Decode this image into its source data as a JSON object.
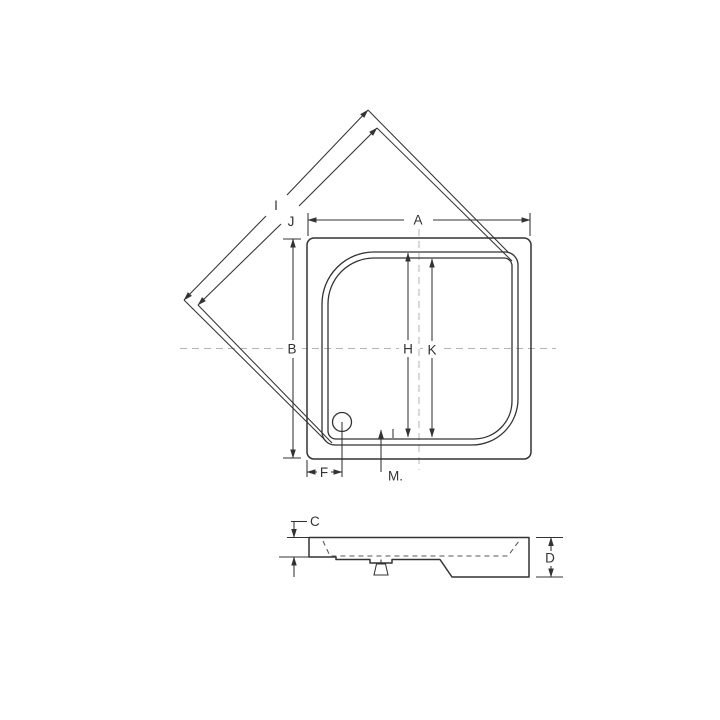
{
  "labels": {
    "a": "A",
    "b": "B",
    "c": "C",
    "d": "D",
    "f": "F",
    "h": "H",
    "i": "I",
    "j": "J",
    "k": "K",
    "m": "M."
  },
  "colors": {
    "line": "#333333",
    "hidden_line": "#555555",
    "centerline": "#b5b5b5",
    "background": "#ffffff"
  }
}
